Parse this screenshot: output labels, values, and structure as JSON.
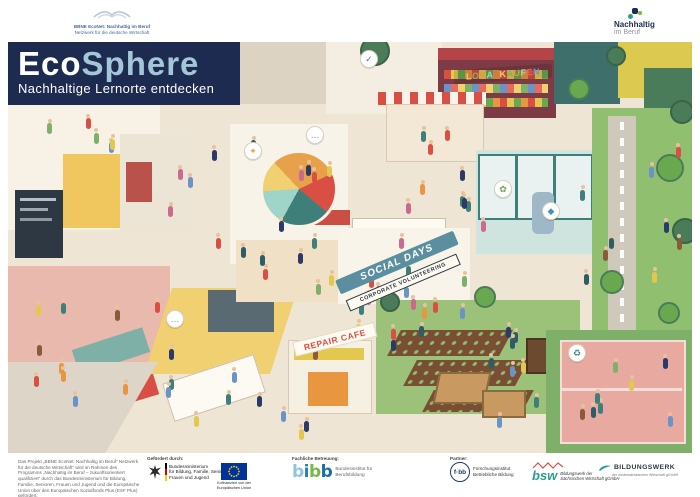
{
  "header": {
    "left_logo": {
      "line1": "BBNE EcoNet: Nachhaltig im Beruf",
      "line2": "Netzwerk für die deutsche Wirtschaft"
    },
    "right_logo": {
      "line1": "Nachhaltig",
      "line2": "im Beruf"
    }
  },
  "title_block": {
    "title_part1": "Eco",
    "title_part2": "Sphere",
    "subtitle": "Nachhaltige Lernorte entdecken",
    "bg_color": "#1d2b50",
    "part2_color": "#a3c6d8"
  },
  "illustration": {
    "signs": {
      "lokal_kaufen": "LOKAL KAUFEN",
      "social_days": "SOCIAL DAYS",
      "corporate_volunteering": "CORPORATE VOLUNTEERING",
      "repair_cafe": "REPAIR CAFE"
    },
    "sign_palette": [
      "#f0d070",
      "#7fb069",
      "#e8963f",
      "#9fd4c8",
      "#e86a5a",
      "#6a93c8"
    ],
    "badges": [
      {
        "x": 352,
        "y": 8,
        "glyph": "✓",
        "color": "#3f7f7a",
        "name": "check-badge"
      },
      {
        "x": 236,
        "y": 100,
        "glyph": "✦",
        "color": "#e8a14b",
        "name": "spark-badge"
      },
      {
        "x": 534,
        "y": 160,
        "glyph": "◆",
        "color": "#4a90b8",
        "name": "water-drop-badge"
      },
      {
        "x": 560,
        "y": 302,
        "glyph": "♻",
        "color": "#3f7f7a",
        "name": "recycle-badge"
      },
      {
        "x": 298,
        "y": 84,
        "glyph": "…",
        "color": "#8a8f98",
        "name": "speech-bubble"
      },
      {
        "x": 158,
        "y": 268,
        "glyph": "…",
        "color": "#8a8f98",
        "name": "speech-bubble"
      },
      {
        "x": 486,
        "y": 138,
        "glyph": "✿",
        "color": "#6aa84f",
        "name": "flower-badge"
      }
    ]
  },
  "footer": {
    "funding_note": "Das Projekt „BBNE EcoNet: Nachhaltig im Beruf“ Netzwerk für die deutsche Wirtschaft“ wird im Rahmen des Programms „Nachhaltig im Beruf – zukunftsorientiert qualifiziert“ durch das Bundesministerium für Bildung, Familie, Senioren, Frauen und Jugend und die Europäische Union über den Europäischen Sozialfonds Plus (ESF Plus) gefördert.",
    "gefoerdert_label": "Gefördert durch:",
    "ministry": "Bundesministerium\nfür Bildung, Familie, Senioren,\nFrauen und Jugend",
    "eu_caption": "Kofinanziert von der\nEuropäischen Union",
    "betreuung_label": "Fachliche Betreuung:",
    "bibb_name": "bibb",
    "bibb_palette": [
      "#8fc3e8",
      "#2a7fc1",
      "#7ab648",
      "#1b6fa8"
    ],
    "bibb_caption": "Bundesinstitut für\nBerufsbildung",
    "partner_label": "Partner:",
    "fbb_logo": "f·bb",
    "fbb_caption": "Forschungsinstitut\nBetriebliche Bildung",
    "bsw_logo": "bsw",
    "bsw_caption": "Bildungswerk der\nSächsischen Wirtschaft gGmbH",
    "bnw_logo": "BILDUNGSWERK",
    "bnw_caption": "der niedersächsischen Wirtschaft gGmbH"
  }
}
